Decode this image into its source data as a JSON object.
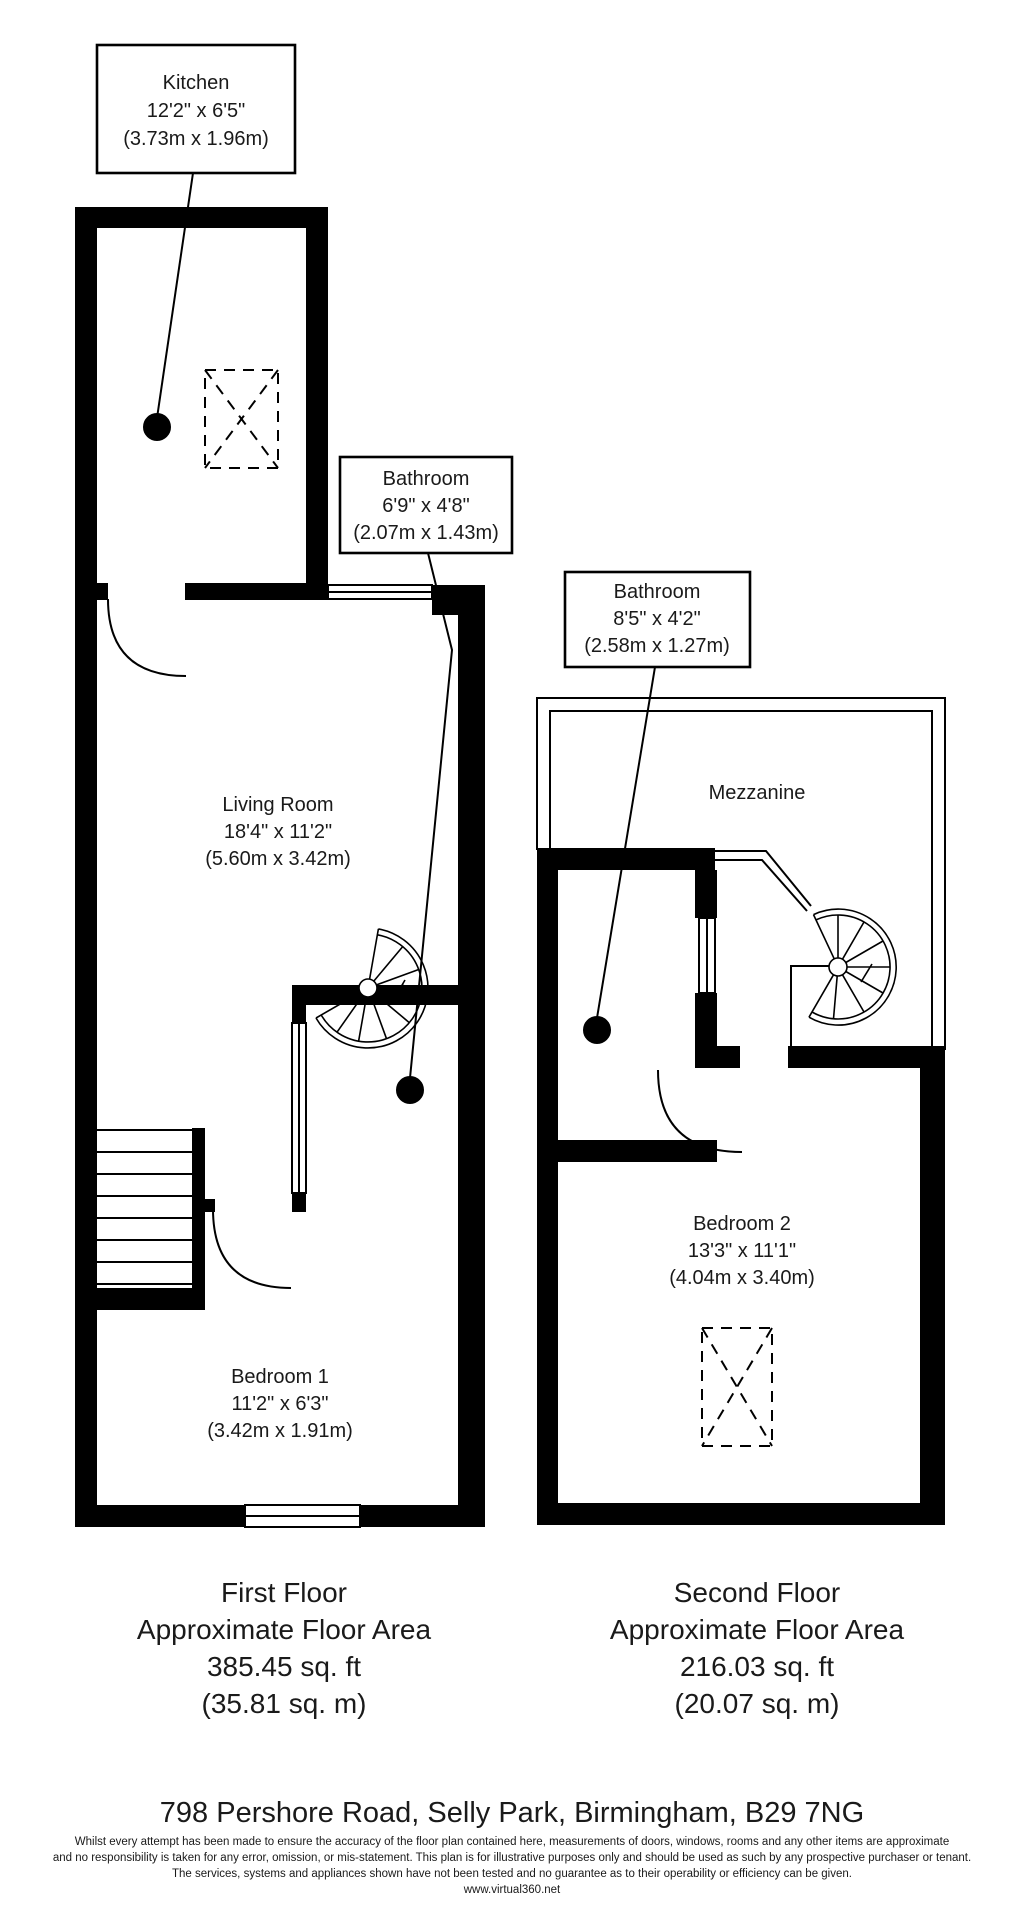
{
  "labels": {
    "kitchen": {
      "name": "Kitchen",
      "imperial": "12'2\" x 6'5\"",
      "metric": "(3.73m x 1.96m)"
    },
    "bathroom_ff": {
      "name": "Bathroom",
      "imperial": "6'9\" x 4'8\"",
      "metric": "(2.07m x 1.43m)"
    },
    "bathroom_sf": {
      "name": "Bathroom",
      "imperial": "8'5\" x 4'2\"",
      "metric": "(2.58m x 1.27m)"
    },
    "living_room": {
      "name": "Living Room",
      "imperial": "18'4\" x 11'2\"",
      "metric": "(5.60m x 3.42m)"
    },
    "mezzanine": {
      "name": "Mezzanine"
    },
    "bedroom1": {
      "name": "Bedroom 1",
      "imperial": "11'2\" x 6'3\"",
      "metric": "(3.42m x 1.91m)"
    },
    "bedroom2": {
      "name": "Bedroom 2",
      "imperial": "13'3\" x 11'1\"",
      "metric": "(4.04m x 3.40m)"
    }
  },
  "floors": {
    "first": {
      "title": "First Floor",
      "subtitle": "Approximate Floor Area",
      "area_ft": "385.45 sq. ft",
      "area_m": "(35.81 sq. m)"
    },
    "second": {
      "title": "Second Floor",
      "subtitle": "Approximate Floor Area",
      "area_ft": "216.03 sq. ft",
      "area_m": "(20.07 sq. m)"
    }
  },
  "footer": {
    "address": "798 Pershore Road, Selly Park, Birmingham, B29 7NG",
    "disclaimer_line1": "Whilst every attempt has been made to ensure the accuracy of the floor plan contained here, measurements of doors, windows, rooms and any other items are approximate",
    "disclaimer_line2": "and no responsibility is taken for any error, omission, or mis-statement. This plan is for illustrative purposes only and should be used as such by any prospective purchaser or tenant.",
    "disclaimer_line3": "The services, systems and appliances shown have not been tested and no guarantee as to their operability or efficiency can be given.",
    "website": "www.virtual360.net"
  },
  "colors": {
    "wall": "#000000",
    "background": "#ffffff"
  }
}
